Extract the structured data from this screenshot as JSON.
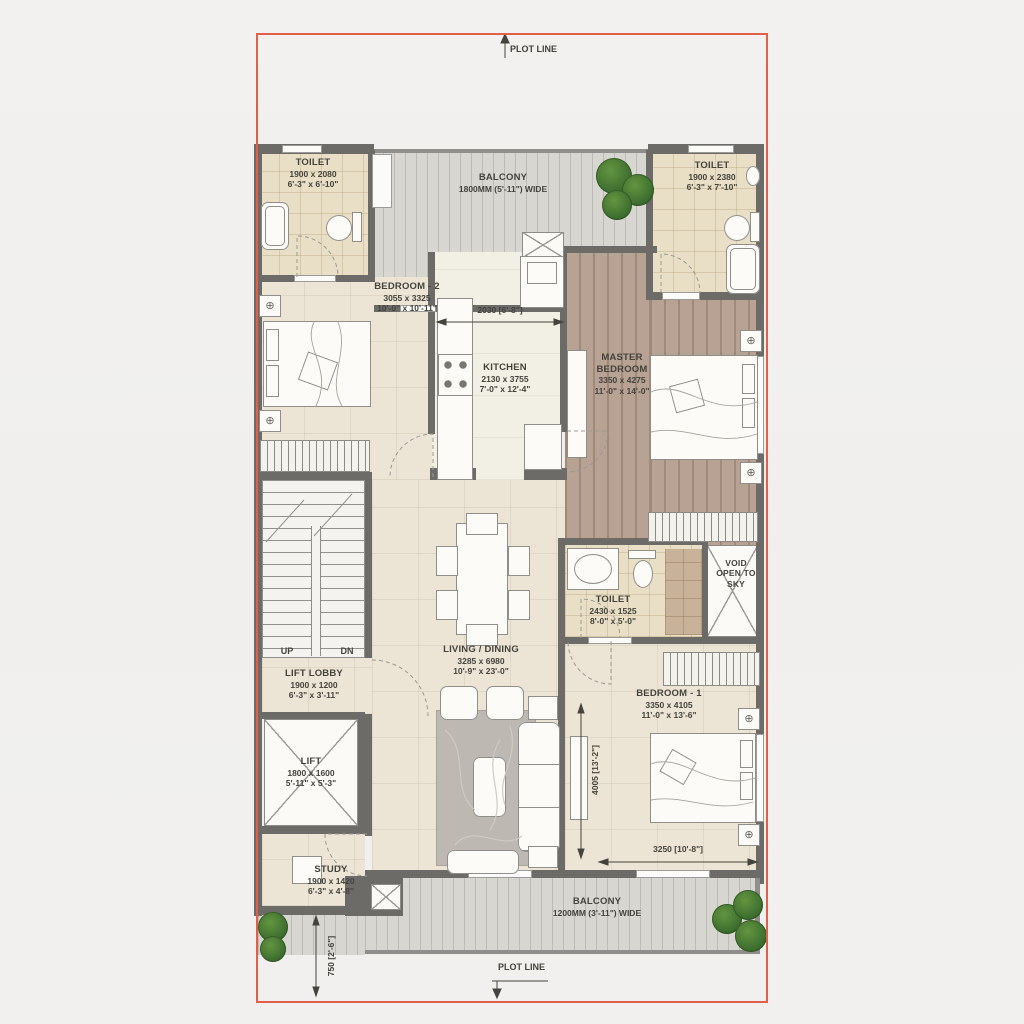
{
  "plot": {
    "top_label": "PLOT LINE",
    "bottom_label": "PLOT LINE",
    "line_color": "#e0604a"
  },
  "rooms": {
    "toilet_top_left": {
      "name": "TOILET",
      "dim_mm": "1900 x 2080",
      "dim_ft": "6'-3\" x 6'-10\""
    },
    "balcony_top": {
      "name": "BALCONY",
      "dim": "1800MM (5'-11\") WIDE"
    },
    "toilet_top_right": {
      "name": "TOILET",
      "dim_mm": "1900 x 2380",
      "dim_ft": "6'-3\" x 7'-10\""
    },
    "bedroom_2": {
      "name": "BEDROOM - 2",
      "dim_mm": "3055 x 3325",
      "dim_ft": "10'-0\" x 10'-11\""
    },
    "kitchen": {
      "name": "KITCHEN",
      "dim_mm": "2130 x 3755",
      "dim_ft": "7'-0\" x 12'-4\""
    },
    "master_bedroom": {
      "name": "MASTER BEDROOM",
      "dim_mm": "3350 x 4275",
      "dim_ft": "11'-0\" x 14'-0\""
    },
    "toilet_mid": {
      "name": "TOILET",
      "dim_mm": "2430 x 1525",
      "dim_ft": "8'-0\" x 5'-0\""
    },
    "void": {
      "name": "VOID OPEN TO SKY"
    },
    "living_dining": {
      "name": "LIVING / DINING",
      "dim_mm": "3285 x 6980",
      "dim_ft": "10'-9\" x 23'-0\""
    },
    "lift_lobby": {
      "name": "LIFT LOBBY",
      "dim_mm": "1900 x 1200",
      "dim_ft": "6'-3\" x 3'-11\""
    },
    "lift": {
      "name": "LIFT",
      "dim_mm": "1800 x 1600",
      "dim_ft": "5'-11\" x 5'-3\""
    },
    "bedroom_1": {
      "name": "BEDROOM - 1",
      "dim_mm": "3350 x 4105",
      "dim_ft": "11'-0\" x 13'-6\""
    },
    "study": {
      "name": "STUDY",
      "dim_mm": "1900 x 1420",
      "dim_ft": "6'-3\" x 4'-8\""
    },
    "balcony_bottom": {
      "name": "BALCONY",
      "dim": "1200MM (3'-11\") WIDE"
    }
  },
  "stairs": {
    "up": "UP",
    "down": "DN"
  },
  "dims": {
    "passage_width": "2030 [6'-8\"]",
    "bedroom1_height": "4005 [13'-2\"]",
    "bedroom1_width": "3250 [10'-8\"]",
    "rear_setback": "750 [2'-6\"]"
  },
  "icons": {
    "lamp": "⊕"
  }
}
